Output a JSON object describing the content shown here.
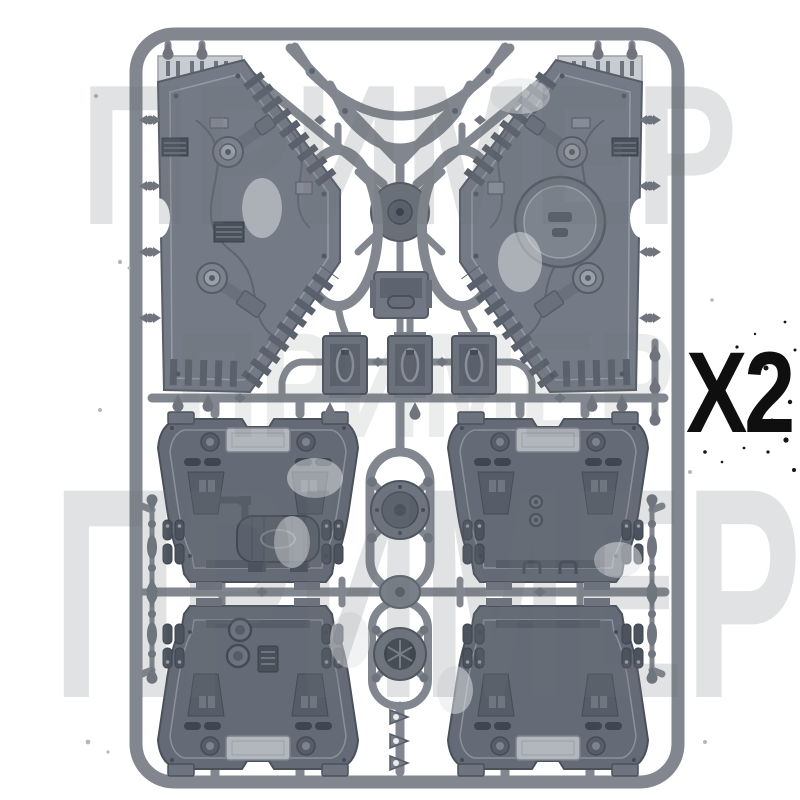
{
  "label": {
    "quantity": "X2"
  },
  "watermark": {
    "lines": [
      "ПРИМЕР",
      "ПРИМЕР",
      "ПРИМЕР"
    ]
  },
  "colors": {
    "background": "#ffffff",
    "runner_gray": "#82878f",
    "hex_panel_gray": "#747b86",
    "container_panel_gray": "#646b76",
    "vent_strip_light": "#c8cbd0",
    "label_text_black": "#0f0f0f",
    "watermark_gray": "#6e7276"
  }
}
